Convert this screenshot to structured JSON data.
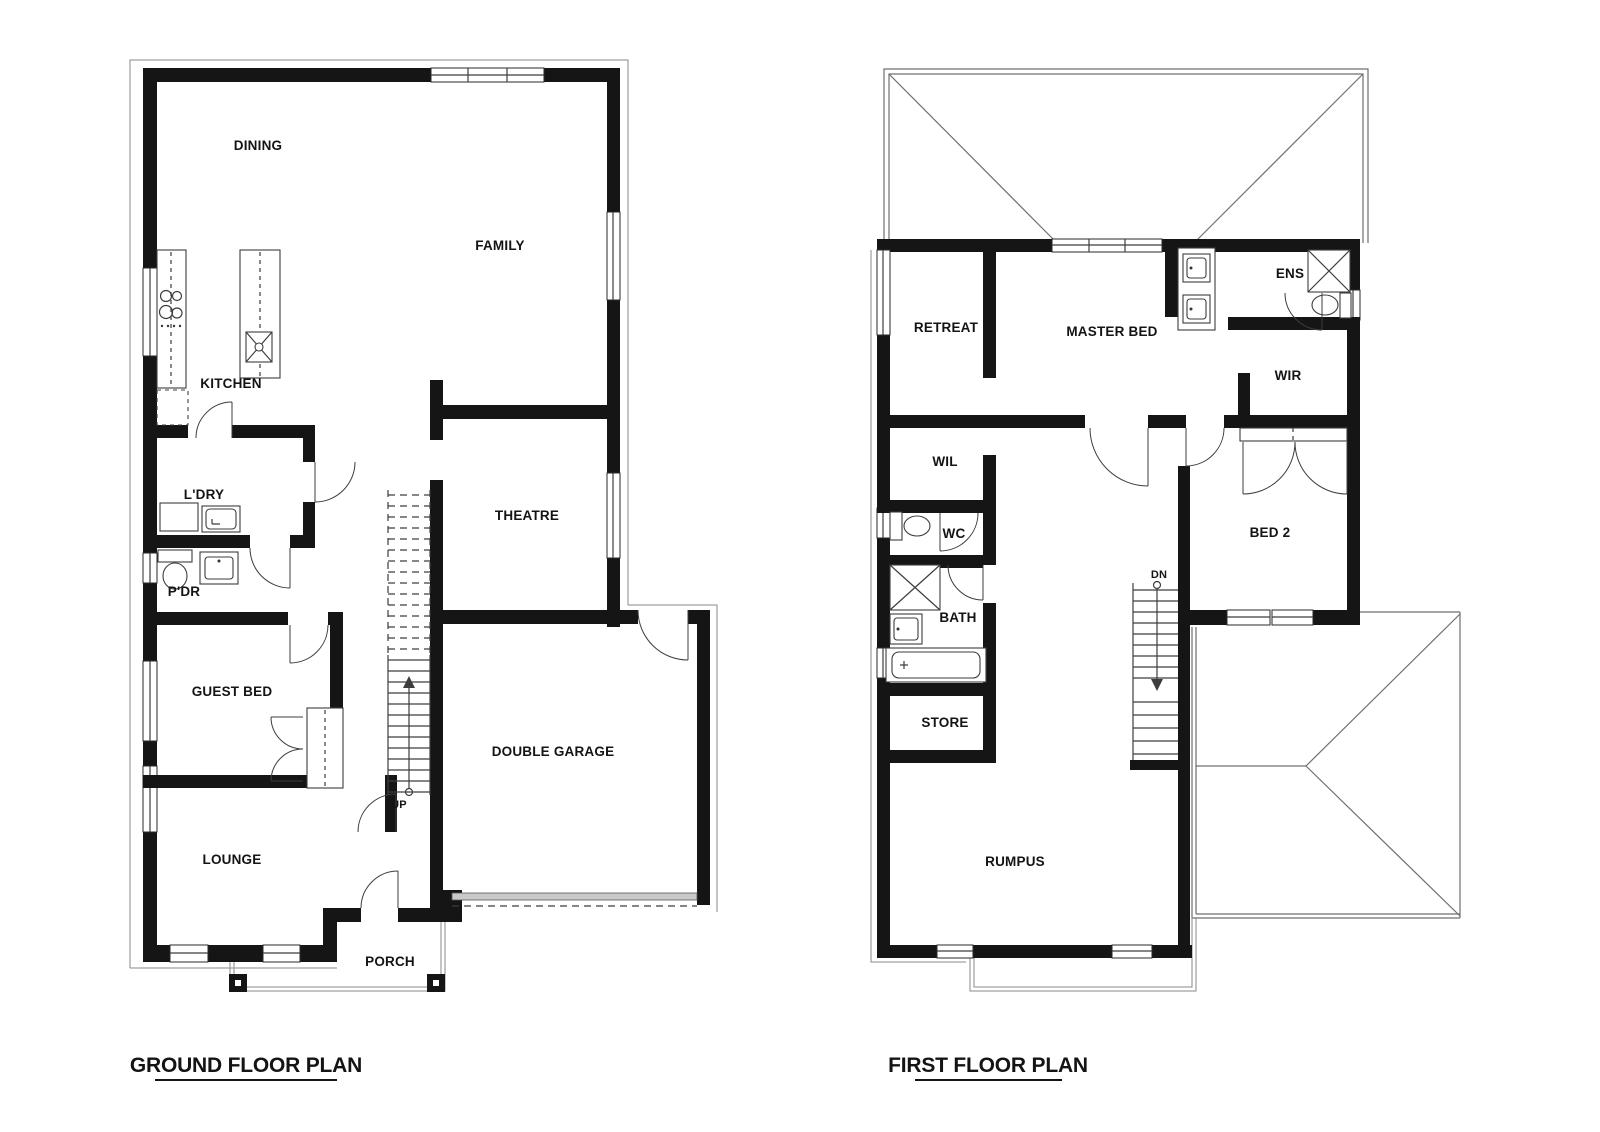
{
  "drawing": {
    "background": "#ffffff",
    "wall_color": "#151515",
    "line_color": "#3d3d3d",
    "roof_line_color": "#6f6f6f"
  },
  "ground_floor": {
    "title": "GROUND FLOOR PLAN",
    "stair_direction_label": "UP",
    "rooms": {
      "dining": "DINING",
      "family": "FAMILY",
      "kitchen": "KITCHEN",
      "laundry": "L'DRY",
      "powder": "P'DR",
      "theatre": "THEATRE",
      "guest_bed": "GUEST BED",
      "garage": "DOUBLE GARAGE",
      "lounge": "LOUNGE",
      "porch": "PORCH"
    }
  },
  "first_floor": {
    "title": "FIRST FLOOR PLAN",
    "stair_direction_label": "DN",
    "rooms": {
      "retreat": "RETREAT",
      "master_bed": "MASTER BED",
      "ensuite": "ENS",
      "wir": "WIR",
      "wil": "WIL",
      "wc": "WC",
      "bath": "BATH",
      "store": "STORE",
      "bed2": "BED 2",
      "rumpus": "RUMPUS"
    }
  }
}
